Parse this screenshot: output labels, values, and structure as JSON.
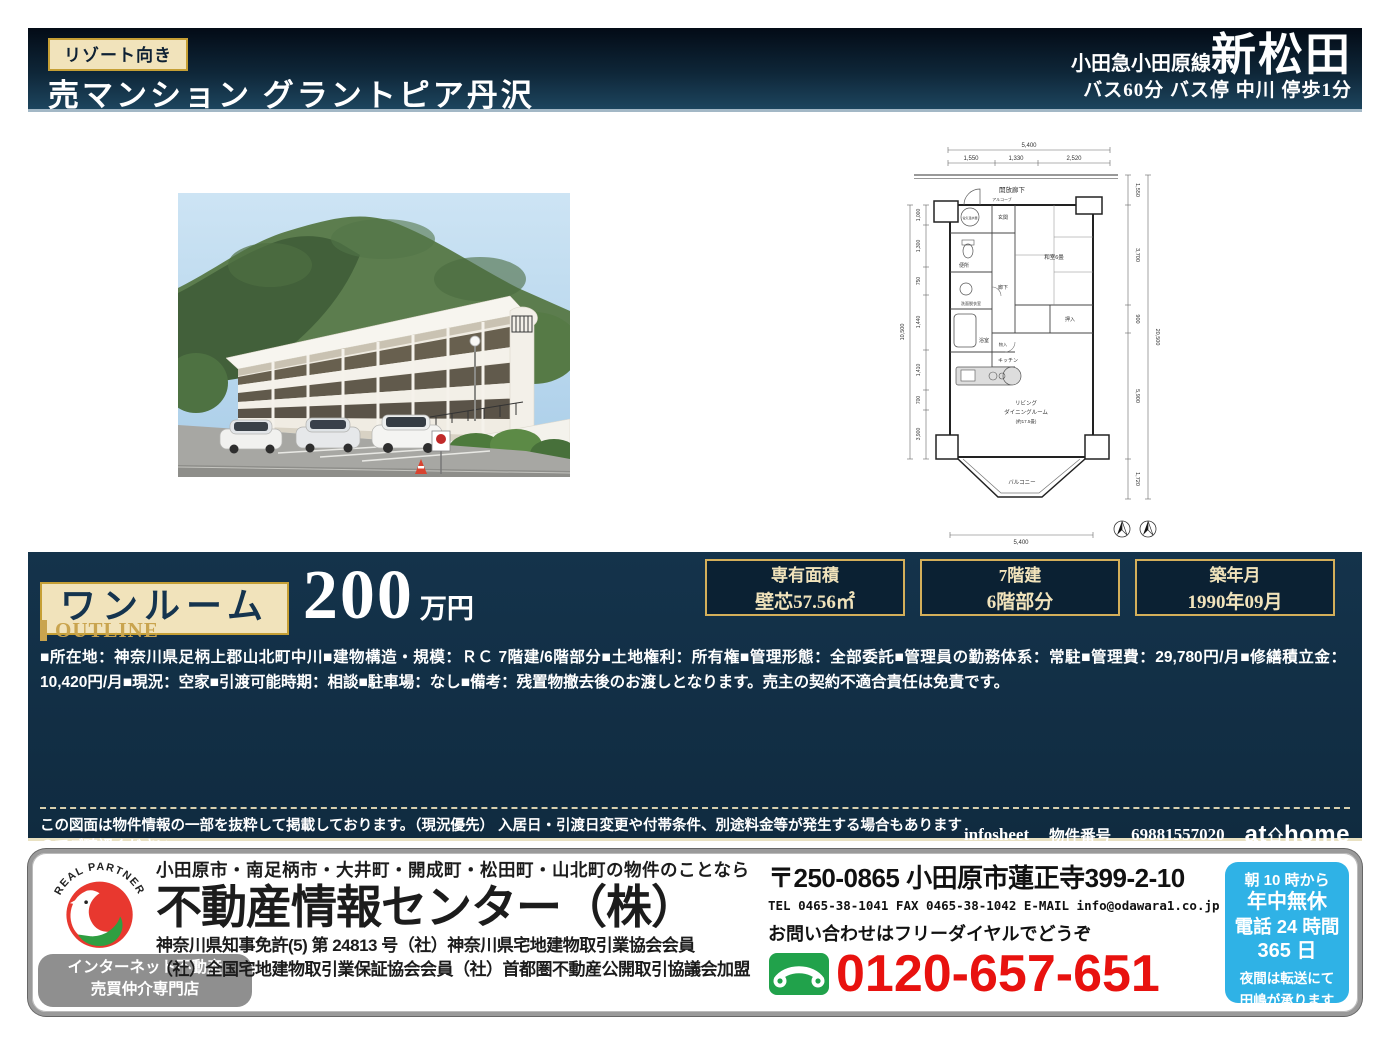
{
  "header": {
    "badge": "リゾート向き",
    "title": "売マンション グラントピア丹沢",
    "rail_line": "小田急小田原線",
    "station": "新松田",
    "access": "バス60分 バス停 中川 停歩1分"
  },
  "price_band": {
    "room_type": "ワンルーム",
    "price_value": "200",
    "price_unit": "万円",
    "info_boxes": [
      {
        "label": "専有面積",
        "value": "壁芯57.56㎡"
      },
      {
        "label": "7階建",
        "value": "6階部分"
      },
      {
        "label": "築年月",
        "value": "1990年09月"
      }
    ]
  },
  "outline": {
    "heading": "OUTLINE",
    "body": "■所在地：神奈川県足柄上郡山北町中川■建物構造・規模：ＲＣ 7階建/6階部分■土地権利：所有権■管理形態：全部委託■管理員の勤務体系：常駐■管理費：29,780円/月■修繕積立金：10,420円/月■現況：空家■引渡可能時期：相談■駐車場：なし■備考：残置物撤去後のお渡しとなります。売主の契約不適合責任は免責です。"
  },
  "disclaimer": {
    "text": "この図面は物件情報の一部を抜粋して掲載しております。（現況優先） 入居日・引渡日変更や付帯条件、別途料金等が発生する場合もありますのでご確認ください。",
    "infosheet": "infosheet",
    "property_no_label": "物件番号",
    "property_no": "69881557020",
    "athome_at": "at",
    "athome_home": "home"
  },
  "footer": {
    "logo_arc": "REAL PARTNER",
    "net_badge_line1": "インターネット不動産",
    "net_badge_line2": "売買仲介専門店",
    "areas": "小田原市・南足柄市・大井町・開成町・松田町・山北町の物件のことなら",
    "company": "不動産情報センター（株）",
    "license1": "神奈川県知事免許(5) 第 24813 号（社）神奈川県宅地建物取引業協会会員",
    "license2": "（社）全国宅地建物取引業保証協会会員（社）首都圏不動産公開取引協議会加盟",
    "postal_address": "〒250-0865 小田原市蓮正寺399-2-10",
    "tel_line": "TEL 0465-38-1041 FAX 0465-38-1042 E-MAIL info@odawara1.co.jp",
    "inquiry": "お問い合わせはフリーダイヤルでどうぞ",
    "freedial_number": "0120-657-651",
    "hours": [
      "朝 10 時から",
      "年中無休",
      "電話 24 時間",
      "365 日",
      "夜間は転送にて",
      "田嶋が承ります"
    ]
  },
  "floorplan": {
    "corridor": "開放廊下",
    "alcove": "アルコーブ",
    "entrance": "玄関",
    "water_heater": "電気温水器",
    "toilet": "便所",
    "washroom": "洗面脱衣室",
    "hallway": "廊下",
    "japanese_room": "和室6畳",
    "closet": "押入",
    "storage": "物入",
    "bath": "浴室",
    "kitchen": "キッチン",
    "living1": "リビング",
    "living2": "ダイニングルーム",
    "living3": "(約17.5畳)",
    "balcony": "バルコニー",
    "dims": {
      "top_total": "5,400",
      "top1": "1,550",
      "top2": "1,330",
      "top3": "2,520",
      "right1": "1,550",
      "right2": "3,700",
      "right3": "900",
      "right4": "5,900",
      "right5": "1,720",
      "right_total": "20,500",
      "left1": "1,000",
      "left2": "1,300",
      "left3": "750",
      "left4": "1,440",
      "left5": "1,410",
      "left6": "700",
      "left7": "3,900",
      "left_total": "10,500",
      "bottom_total": "5,400"
    }
  },
  "colors": {
    "navy_band": "#112e44",
    "gold": "#c59f35",
    "cream": "#f1e3bb",
    "price_red": "#e8120f",
    "freedial_green": "#21a24b",
    "hours_blue": "#2fb2e6"
  }
}
